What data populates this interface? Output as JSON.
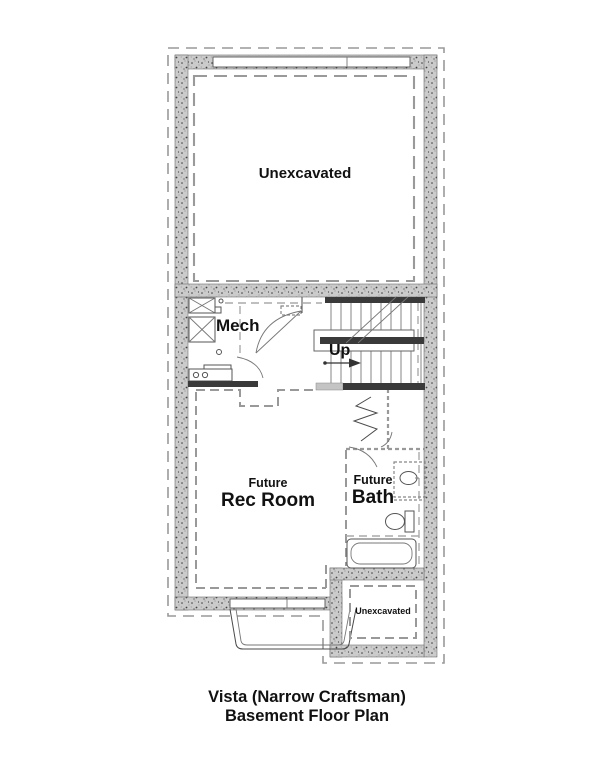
{
  "labels": {
    "unexcavated_top": "Unexcavated",
    "mech": "Mech",
    "up": "Up",
    "rec_room_line1": "Future",
    "rec_room_line2": "Rec Room",
    "bath_line1": "Future",
    "bath_line2": "Bath",
    "unexcavated_bottom": "Unexcavated"
  },
  "title": {
    "line1": "Vista (Narrow Craftsman)",
    "line2": "Basement Floor Plan"
  },
  "symbols": [
    "stairs-icon",
    "up-arrow-icon",
    "stair-break-icon",
    "water-heater-icon",
    "furnace-icon",
    "floor-drain-icon",
    "laundry-sink-icon",
    "door-swing-icon",
    "bifold-door-icon",
    "vanity-sink-icon",
    "toilet-icon",
    "bathtub-icon",
    "egress-window-icon",
    "window-well-icon"
  ],
  "colors": {
    "wall_fill": "#cbcbcb",
    "wall_speckle": "#3f3f3f",
    "line": "#4a4a4a",
    "dark_bar": "#3a3a3a",
    "dashed_line": "#999999",
    "light_bar": "#c4c4c4",
    "text": "#111111",
    "background": "#ffffff"
  }
}
